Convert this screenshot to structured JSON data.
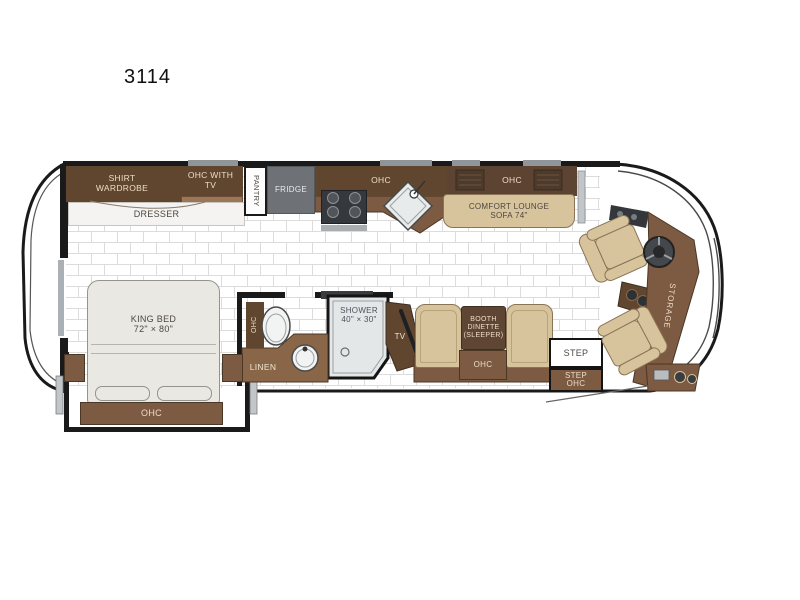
{
  "title": "3114",
  "colors": {
    "dark_brown": "#61462f",
    "mid_brown": "#7d5a42",
    "light_brown": "#9b7757",
    "tan": "#d7c49c",
    "appliance_gray": "#6e7276",
    "wall_black": "#1a1a1a",
    "tile_line": "#dcdcdc",
    "shower_fill": "#e3e7e7"
  },
  "labels": {
    "shirt_wardrobe": "SHIRT\nWARDROBE",
    "ohc_with_tv": "OHC WITH\nTV",
    "pantry": "PANTRY",
    "fridge": "FRIDGE",
    "kitchen_ohc": "OHC",
    "sofa_ohc": "OHC",
    "comfort_lounge": "COMFORT LOUNGE\nSOFA 74\"",
    "dresser": "DRESSER",
    "king_bed": "KING BED\n72\" × 80\"",
    "bed_ohc": "OHC",
    "bath_ohc": "OHC",
    "linen": "LINEN",
    "shower": "SHOWER\n40\" × 30\"",
    "tv": "TV",
    "booth_dinette": "BOOTH\nDINETTE\n(SLEEPER)",
    "dinette_ohc": "OHC",
    "step": "STEP",
    "step_ohc": "STEP\nOHC",
    "storage": "STORAGE"
  }
}
